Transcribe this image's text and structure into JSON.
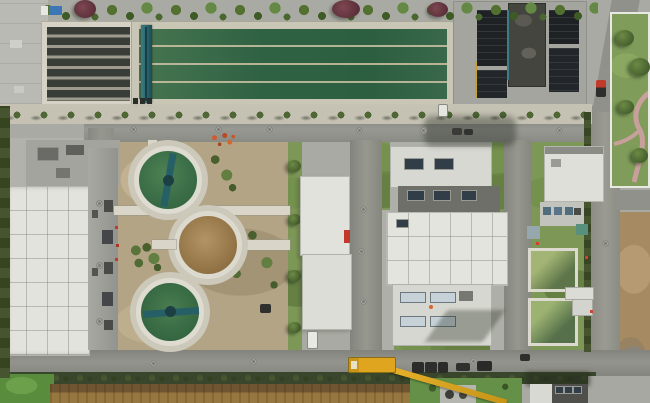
{
  "meta": {
    "title": "Aerial drone photograph of a wastewater treatment plant",
    "media_type": "photograph",
    "visible_text": "none"
  },
  "palette": {
    "concrete_base": "#a9aaa3",
    "pavement_light": "#c6c3b4",
    "road_gray": "#8e8f89",
    "roof_white": "#e3e3dd",
    "roof_dark_band": "#6e6f68",
    "covered_tank_black": "#1f2225",
    "dark_building_gray": "#45453f",
    "aeration_water_green": "#2f6243",
    "filter_lane_dark": "#383d37",
    "clarifier_water_green": "#41744a",
    "clarifier_sludge_brown": "#a5854f",
    "gantry_bridge_teal": "#2d6a72",
    "bare_soil_tan": "#b3a486",
    "lawn_green": "#7d9757",
    "tree_green": "#4c6532",
    "tree_red_foliage": "#5a2f3a",
    "farm_field_brown": "#86683a",
    "hedge_dark_green": "#3a462c",
    "crane_yellow": "#dfa51e",
    "garden_path_pink": "#c79f9b",
    "accent_red": "#c2392b",
    "accent_blue_container": "#3d76b5",
    "small_basin_olive": "#9cb271"
  },
  "scene": {
    "structures": [
      "rectangular-filter-basin-with-dark-lanes",
      "long-aeration-basin-green-water-four-lanes",
      "teal-traveling-bridge-gantry",
      "covered-black-tank-complex-with-dark-building",
      "three-circular-clarifiers-two-green-one-brown",
      "large-white-roof-process-building",
      "gray-annex-building-with-windows",
      "central-narrow-white-building",
      "central-white-building-complex-with-skylights",
      "small-white-building-on-lawn",
      "two-small-olive-green-basins",
      "walled-garden-with-pink-path",
      "mobile-crane-with-extended-boom",
      "parked-trucks-and-cars",
      "plowed-farm-field-strip",
      "perimeter-roads-with-manhole-covers"
    ],
    "vehicle_counts": {
      "crane": 1,
      "dark_trucks": 5,
      "white_cars": 3,
      "red_vehicle": 1
    },
    "clarifier_count": 3,
    "lighting": "midday-sun-shadows-to-lower-left"
  }
}
